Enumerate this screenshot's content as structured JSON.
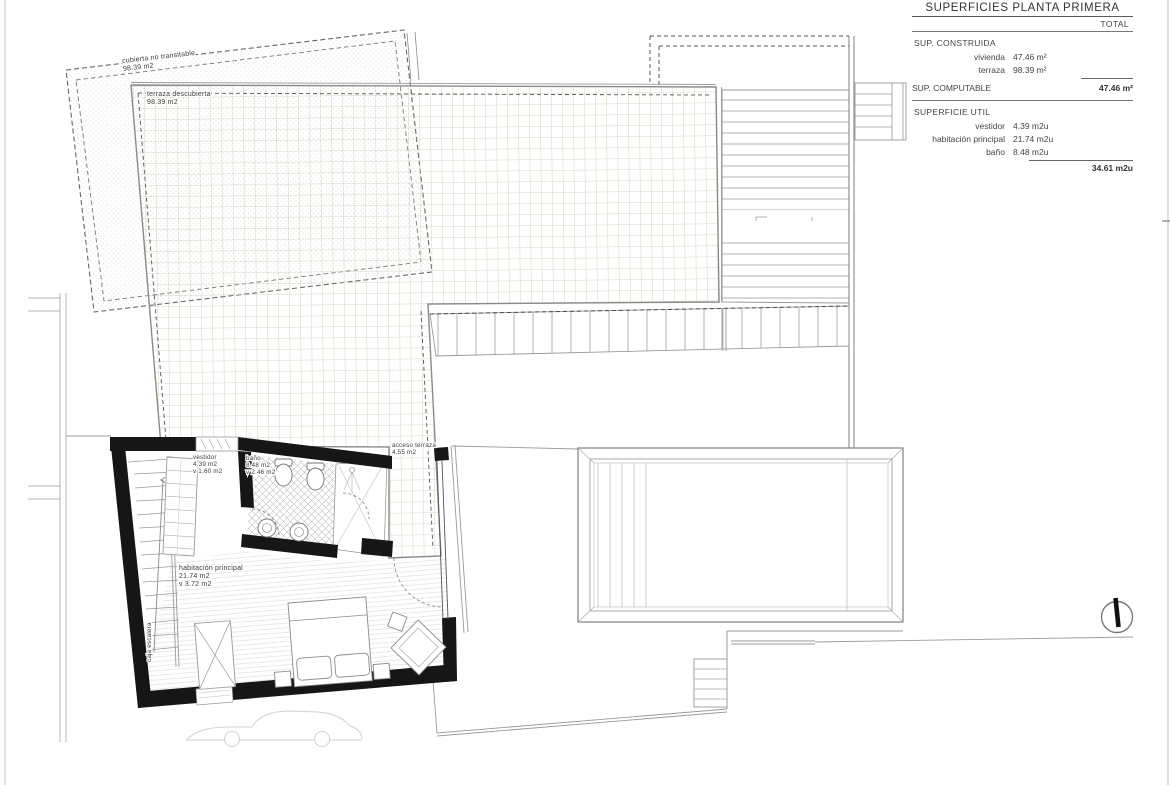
{
  "page": {
    "background": "#ffffff",
    "frame_color": "#dcdcdc",
    "wall_color": "#161616",
    "tile_line_color": "#ccc9ae"
  },
  "table": {
    "title": "SUPERFICIES PLANTA PRIMERA",
    "total_header": "TOTAL",
    "constructed": {
      "label": "SUP. CONSTRUIDA",
      "rows": [
        {
          "name": "vivienda",
          "value": "47.46 m²"
        },
        {
          "name": "terraza",
          "value": "98.39 m²"
        }
      ]
    },
    "computable": {
      "label": "SUP. COMPUTABLE",
      "total": "47.46 m²"
    },
    "useful": {
      "label": "SUPERFICIE UTIL",
      "rows": [
        {
          "name": "vestidor",
          "value": "4.39 m2u"
        },
        {
          "name": "habitación principal",
          "value": "21.74 m2u"
        },
        {
          "name": "baño",
          "value": "8.48 m2u"
        }
      ],
      "total": "34.61 m2u"
    }
  },
  "plan": {
    "cubierta": {
      "name": "cubierta no transitable",
      "area": "98.39 m2"
    },
    "terraza": {
      "name": "terraza descubierta",
      "area": "98.39 m2"
    },
    "vestidor": {
      "name": "vestidor",
      "area": "4.39 m2",
      "vent": "v 1.60 m2"
    },
    "bano": {
      "name": "baño",
      "area": "8.48 m2",
      "vent": "v 2.46 m2"
    },
    "habitacion": {
      "name": "habitación principal",
      "area": "21.74 m2",
      "vent": "v 3.72 m2"
    },
    "acceso": {
      "name": "acceso terraza",
      "area": "4.55 m2"
    },
    "escalera": {
      "name": "caja escalera"
    }
  }
}
